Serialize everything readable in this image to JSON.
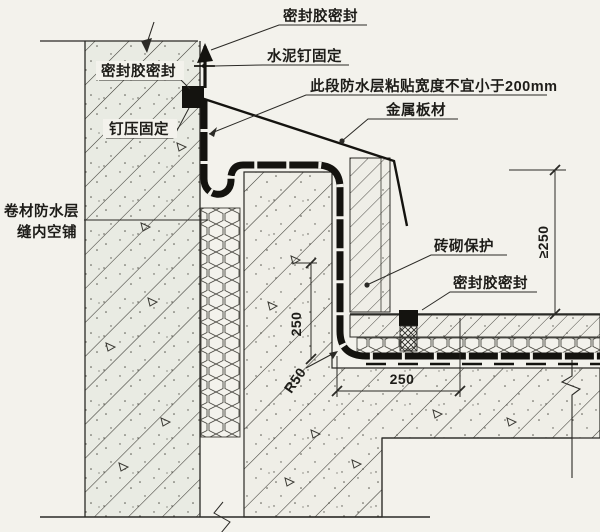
{
  "drawing": {
    "labels": {
      "seal_top": "密封胶密封",
      "cement_nail": "水泥钉固定",
      "adhesion_note": "此段防水层粘贴宽度不宜小于200mm",
      "metal_sheet": "金属板材",
      "seal_left": "密封胶密封",
      "nail_press": "钉压固定",
      "membrane_1": "卷材防水层",
      "membrane_2": "缝内空铺",
      "brick_protection": "砖砌保护",
      "seal_right": "密封胶密封"
    },
    "dimensions": {
      "flashing_height": "≥250",
      "upstand_height": "250",
      "fillet_radius": "R50",
      "protection_width": "250"
    },
    "colors": {
      "ink": "#2b2a26",
      "paper": "#f3f2ec",
      "wall_fill": "#e9ebe3",
      "mass_fill": "#efeee7"
    }
  }
}
